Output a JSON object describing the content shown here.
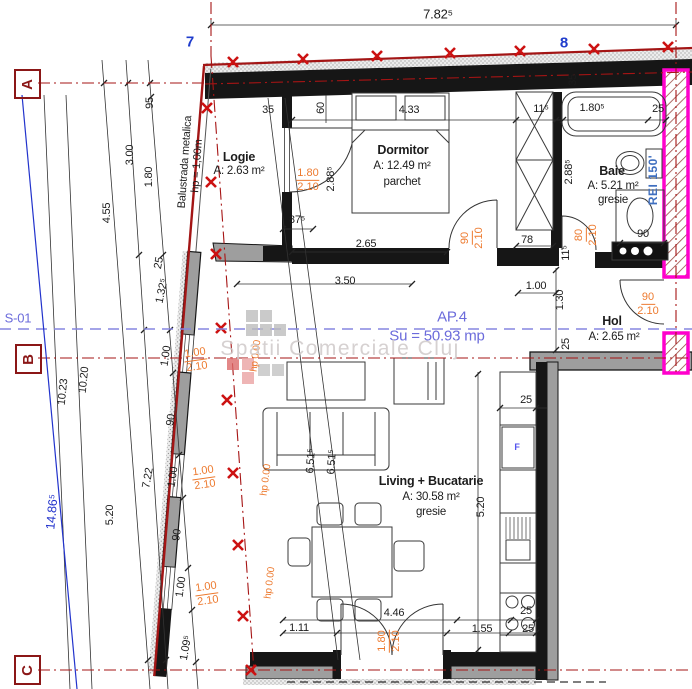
{
  "drawing": {
    "section_label": "S-01",
    "apartment_label": "AP.4",
    "apartment_area": "Su = 50.93 mp",
    "fire_rating": "REI 150'",
    "watermark": "Spatii Comerciale Cluj",
    "balustrade_note_1": "Balustrada metalica",
    "balustrade_note_2": "hp = 1,00m",
    "fridge_symbol": "F"
  },
  "grid": {
    "rows": [
      "A",
      "B",
      "C"
    ],
    "cols": [
      "7",
      "8"
    ]
  },
  "rooms": {
    "logie": {
      "name": "Logie",
      "area": "A: 2.63 m²"
    },
    "dormitor": {
      "name": "Dormitor",
      "area": "A: 12.49 m²",
      "finish": "parchet"
    },
    "baie": {
      "name": "Baie",
      "area": "A: 5.21 m²",
      "finish": "gresie"
    },
    "hol": {
      "name": "Hol",
      "area": "A: 2.65 m²"
    },
    "living": {
      "name": "Living + Bucatarie",
      "area": "A: 30.58 m²",
      "finish": "gresie"
    }
  },
  "dims": {
    "total_width": "7.82⁵",
    "total_height": "14.86⁵",
    "v95": "95",
    "v300": "3.00",
    "v180": "1.80",
    "v455": "4.55",
    "v25_top": "25",
    "v1325": "1.32⁵",
    "v1023": "10.23",
    "v1020": "10.20",
    "v722": "7.22",
    "v520": "5.20",
    "v100_0": "1.00",
    "v90_0": "90",
    "w100_1": "1.00",
    "w90_1": "90",
    "w100_2": "1.00",
    "w1095": "1.09⁵",
    "logie_875": "87⁵",
    "logie_35": "35",
    "logie_60": "60",
    "logie_288": "2.88⁵",
    "wall_35": "35",
    "dorm_433": "4.33",
    "dorm_115": "11⁵",
    "dorm_288": "2.88⁵",
    "dorm_265": "2.65",
    "dorm_350": "3.50",
    "dorm_78": "78",
    "baie_1805": "1.80⁵",
    "baie_25": "25",
    "baie_90": "90",
    "baie_115": "11⁵",
    "hol_100": "1.00",
    "hol_130": "1.30",
    "hol_25": "25",
    "kit_25": "25",
    "kit_520": "5.20",
    "diag_1": "6.51⁵",
    "diag_2": "6.51⁵",
    "bot_446": "4.46",
    "bot_111": "1.11",
    "bot_155": "1.55",
    "bot_25a": "25",
    "bot_25b": "25"
  },
  "openings": {
    "logie_door": {
      "w": "1.80",
      "h": "2.10"
    },
    "dormitor_door": {
      "w": "90",
      "h": "2.10"
    },
    "baie_door": {
      "w": "80",
      "h": "2.10"
    },
    "entry_door": {
      "w": "90",
      "h": "2.10"
    },
    "terrace_door": {
      "w": "1.80",
      "h": "2.10"
    },
    "window1": {
      "w": "1.00",
      "h": "2.10",
      "sill": "hp 0.00"
    },
    "window2": {
      "w": "1.00",
      "h": "2.10",
      "sill": "hp 0.00"
    },
    "window3": {
      "w": "1.00",
      "h": "2.10",
      "sill": "hp 0.00"
    }
  }
}
